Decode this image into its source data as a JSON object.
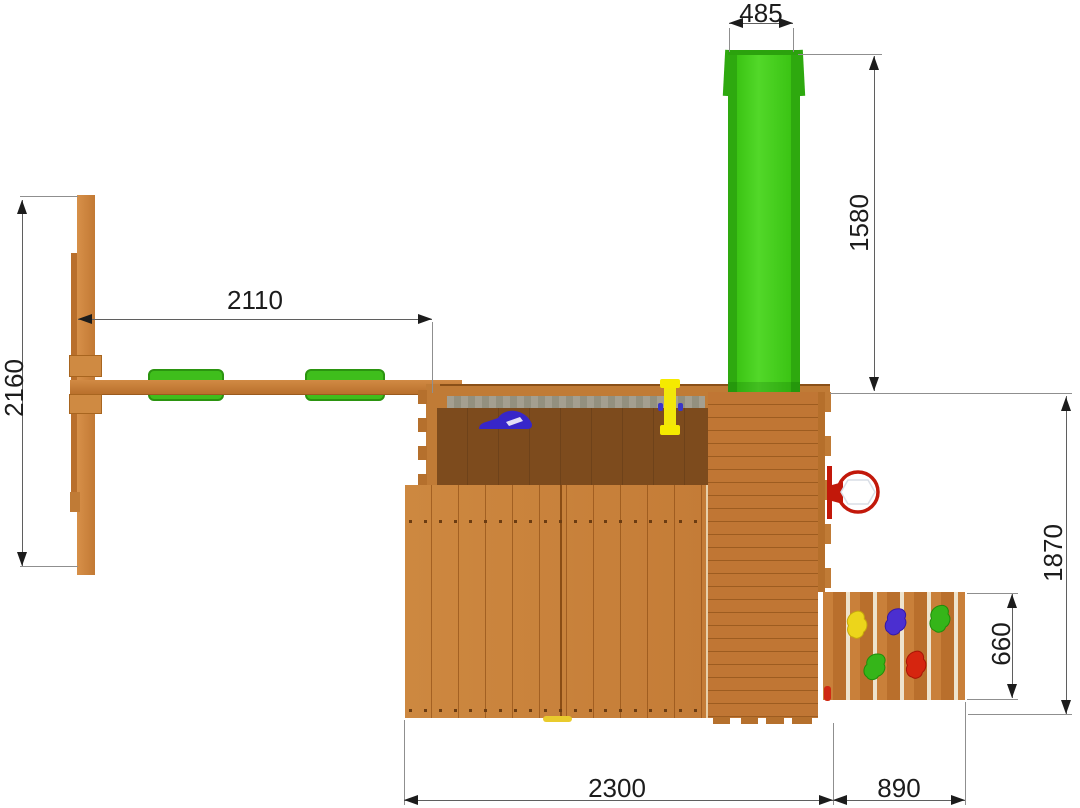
{
  "diagram": {
    "kind": "top-view dimension drawing of a wooden playground set",
    "background": "#ffffff"
  },
  "dimensions": {
    "slide_width": "485",
    "slide_length": "1580",
    "swing_beam_length": "2110",
    "swing_frame_depth": "2160",
    "platform_depth": "1870",
    "climb_wall_depth": "660",
    "main_width": "2300",
    "climb_wall_width": "890"
  },
  "colors": {
    "wood": "#c9823d",
    "wood_dark_interior": "#7d4b1d",
    "slide_green": "#3bc414",
    "swing_pad_green": "#3fbe1c",
    "hoop_red": "#c2180a",
    "hold_yellow": "#ecd51b",
    "hold_purple": "#4b2fd0",
    "hold_green": "#35b519",
    "hold_red": "#d6250f",
    "tarp_gray": "#9c988a",
    "dimension_line": "#5f5f5f",
    "text": "#1c1c1c"
  },
  "components": [
    "swing-frame",
    "swing-beam",
    "swing-seat-pads",
    "main-tower",
    "pitched-roof",
    "deck",
    "green-slide",
    "basketball-hoop",
    "climbing-wall",
    "climbing-holds",
    "periscope",
    "grab-handle"
  ]
}
